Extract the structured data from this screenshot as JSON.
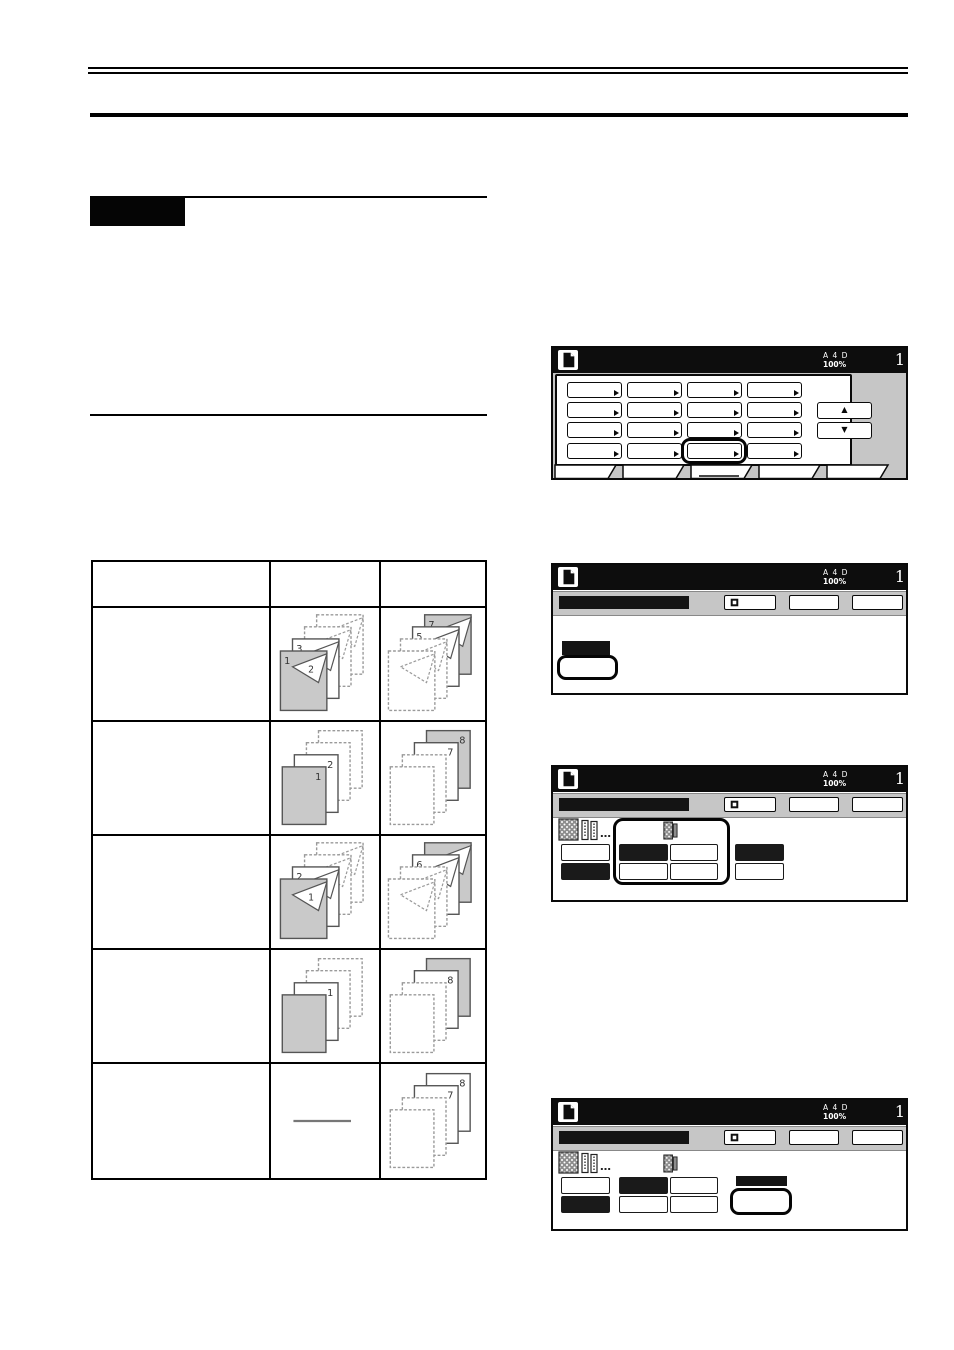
{
  "page": {
    "banner": {
      "label": ""
    },
    "table_columns": [
      "",
      "",
      ""
    ]
  },
  "lcd": {
    "status": {
      "letters": "A 4 D",
      "zoom": "100%",
      "count": "1"
    },
    "glyphs": {
      "up": "▲",
      "down": "▼",
      "ellipsis": "…"
    },
    "panels": [
      {
        "name": "function-menu",
        "kind": "menu",
        "grid": {
          "cols": 4,
          "rows": 4,
          "highlight_row": 3,
          "highlight_col": 2
        },
        "tabs": {
          "count": 5,
          "active": 2
        }
      },
      {
        "name": "mode-setting",
        "kind": "setting",
        "header_buttons": [
          {
            "icon": "register-icon"
          },
          {},
          {}
        ]
      },
      {
        "name": "sort-mode-a",
        "kind": "sort",
        "header_buttons": [
          {
            "icon": "register-icon"
          },
          {},
          {}
        ],
        "left_buttons": [
          "white",
          "black"
        ],
        "group": {
          "outlined": true,
          "grid": [
            [
              "black",
              "white"
            ],
            [
              "white",
              "white"
            ]
          ]
        },
        "right": {
          "kind": "pair",
          "buttons": [
            "black",
            "white"
          ]
        }
      },
      {
        "name": "sort-mode-b",
        "kind": "sort",
        "header_buttons": [
          {
            "icon": "register-icon"
          },
          {},
          {}
        ],
        "left_buttons": [
          "white",
          "black"
        ],
        "group": {
          "outlined": false,
          "grid": [
            [
              "black",
              "white"
            ],
            [
              "white",
              "white"
            ]
          ]
        },
        "right": {
          "kind": "label-ok"
        }
      }
    ]
  },
  "table": {
    "rows": [
      {
        "description": "",
        "original": {
          "kind": "two_sided",
          "sheets": [
            {
              "fill": "dashed"
            },
            {
              "fill": "dashed"
            },
            {
              "fill": "white",
              "label": "3",
              "fold": "4"
            },
            {
              "fill": "gray",
              "label": "1",
              "fold": "2"
            }
          ]
        },
        "copies": {
          "kind": "two_sided",
          "sheets": [
            {
              "fill": "gray",
              "label": "7",
              "fold": "8"
            },
            {
              "fill": "white",
              "label": "5",
              "fold": "6"
            },
            {
              "fill": "dashed"
            },
            {
              "fill": "dashed"
            }
          ]
        }
      },
      {
        "description": "",
        "original": {
          "kind": "one_sided",
          "sheets": [
            {
              "fill": "dashed"
            },
            {
              "fill": "dashed"
            },
            {
              "fill": "white",
              "label": "2"
            },
            {
              "fill": "gray",
              "label": "1"
            }
          ]
        },
        "copies": {
          "kind": "one_sided",
          "sheets": [
            {
              "fill": "gray",
              "label": "8"
            },
            {
              "fill": "white",
              "label": "7"
            },
            {
              "fill": "dashed"
            },
            {
              "fill": "dashed"
            }
          ]
        }
      },
      {
        "description": "",
        "original": {
          "kind": "two_sided",
          "sheets": [
            {
              "fill": "dashed"
            },
            {
              "fill": "dashed"
            },
            {
              "fill": "white",
              "label": "2",
              "fold": "3"
            },
            {
              "fill": "gray",
              "fold": "1"
            }
          ]
        },
        "copies": {
          "kind": "two_sided",
          "sheets": [
            {
              "fill": "gray",
              "fold": "8"
            },
            {
              "fill": "white",
              "label": "6",
              "fold": "7"
            },
            {
              "fill": "dashed"
            },
            {
              "fill": "dashed"
            }
          ]
        }
      },
      {
        "description": "",
        "original": {
          "kind": "one_sided",
          "sheets": [
            {
              "fill": "dashed"
            },
            {
              "fill": "dashed"
            },
            {
              "fill": "white",
              "label": "1"
            },
            {
              "fill": "gray"
            }
          ]
        },
        "copies": {
          "kind": "one_sided",
          "sheets": [
            {
              "fill": "gray"
            },
            {
              "fill": "white",
              "label": "8"
            },
            {
              "fill": "dashed"
            },
            {
              "fill": "dashed"
            }
          ]
        }
      },
      {
        "description": "",
        "original": {
          "kind": "none"
        },
        "copies": {
          "kind": "one_sided",
          "sheets": [
            {
              "fill": "white",
              "label": "8"
            },
            {
              "fill": "white",
              "label": "7"
            },
            {
              "fill": "dashed"
            },
            {
              "fill": "dashed"
            }
          ]
        }
      }
    ]
  }
}
